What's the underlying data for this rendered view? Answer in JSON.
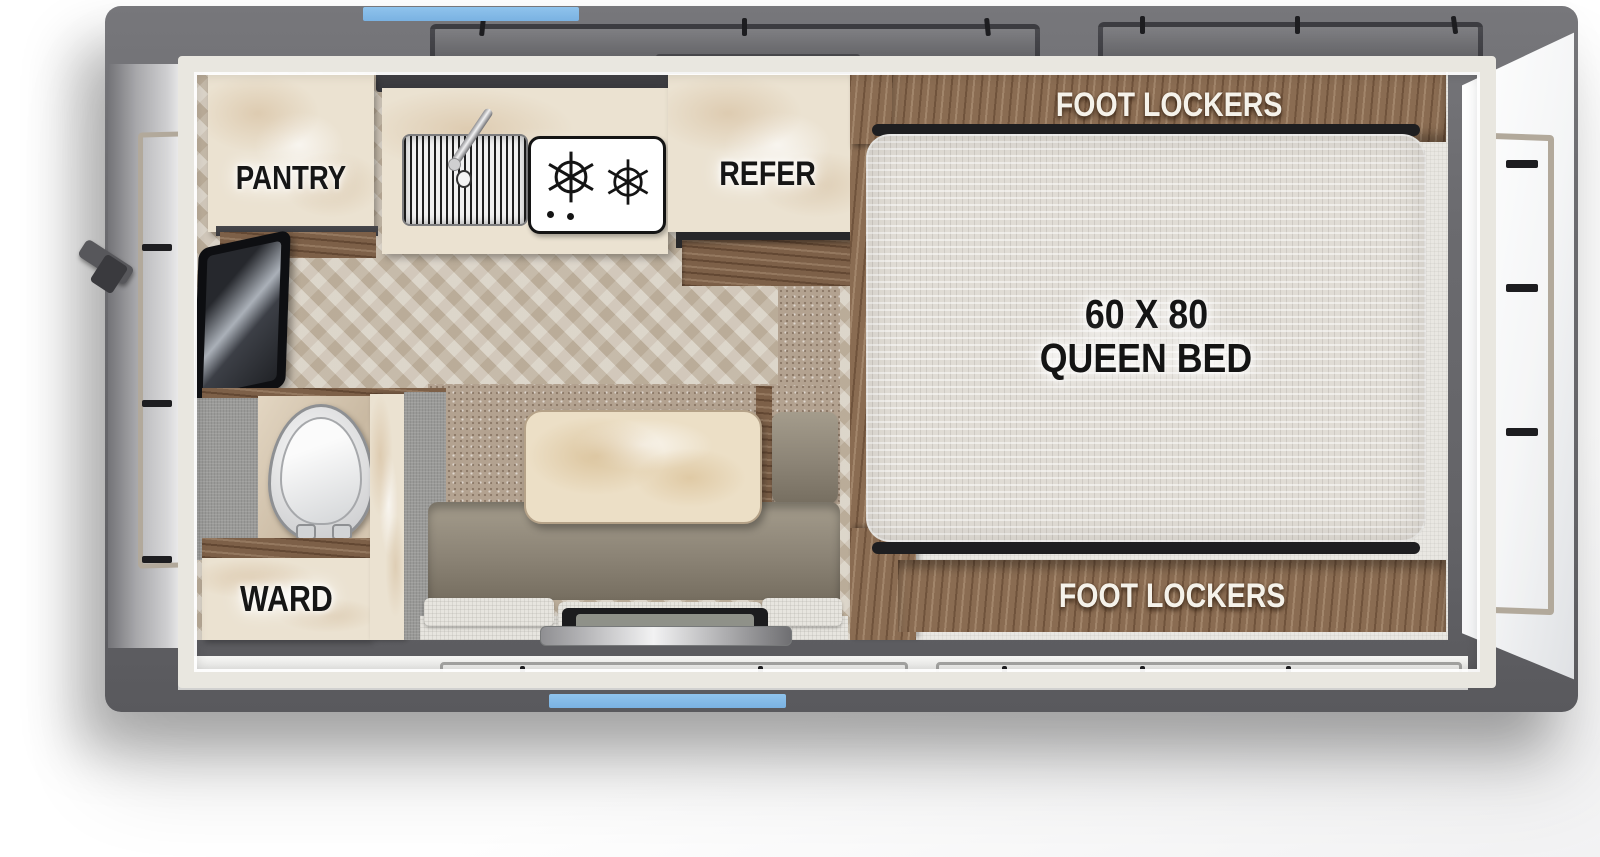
{
  "floorplan": {
    "labels": {
      "pantry": "PANTRY",
      "refrigerator": "REFER",
      "wardrobe": "WARD",
      "foot_lockers_top": "FOOT LOCKERS",
      "foot_lockers_bottom": "FOOT LOCKERS",
      "bed_size": "60 X 80",
      "bed_type": "QUEEN BED"
    },
    "colors": {
      "accent_blue": "#7AB2E2",
      "shell_gray": "#6B6B6F",
      "wood_brown": "#8A6C52",
      "cabinet_cream": "#EBE2D1",
      "carpet_tan": "#B3A290",
      "dinette_olive": "#8C8476",
      "mattress_white": "#E0DCD5",
      "floor_wood": "#CBC0AF"
    },
    "fixtures": [
      "tv",
      "kitchen-sink",
      "faucet",
      "cooktop-2-burner",
      "refrigerator-drawer",
      "toilet",
      "dinette-table",
      "bench-seat",
      "entry-step",
      "queen-bed",
      "window-decals"
    ]
  }
}
